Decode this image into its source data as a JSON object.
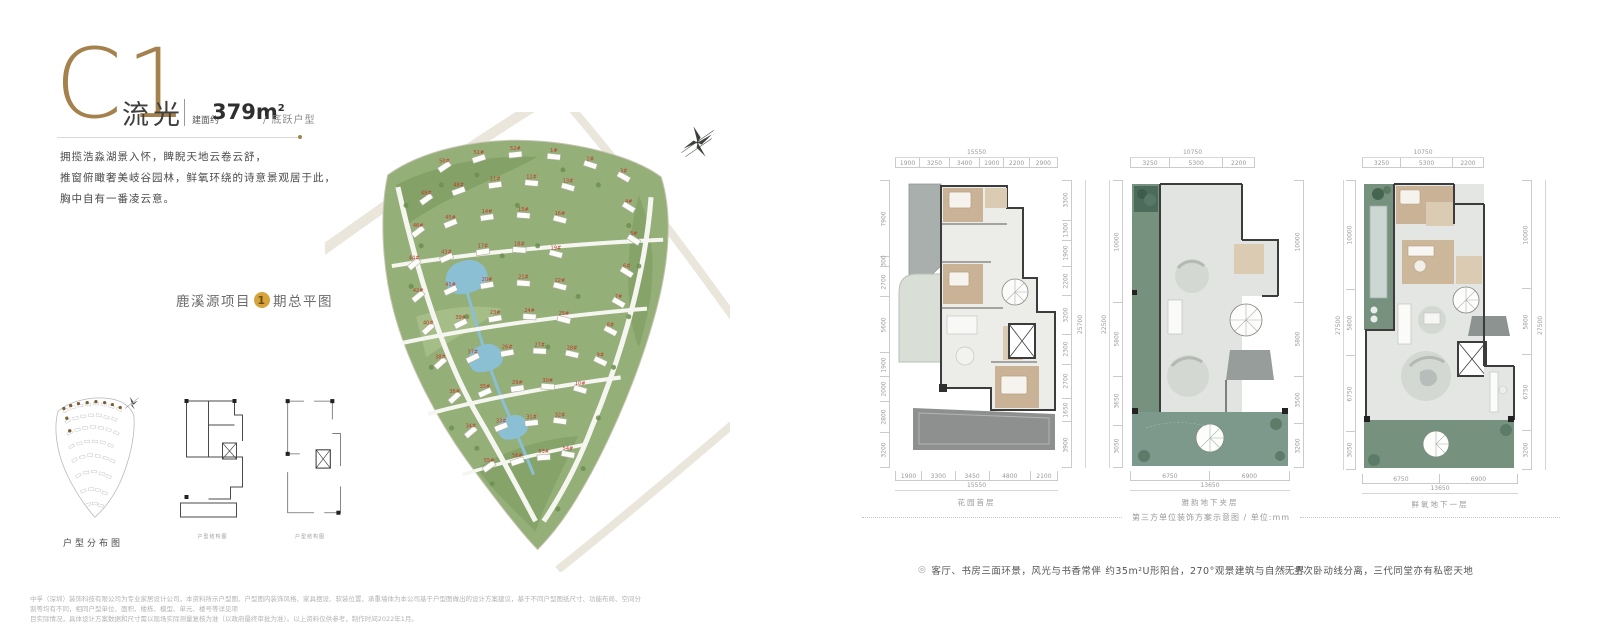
{
  "header": {
    "unit_code": "C1",
    "unit_name": "流光",
    "area_label": "建面约",
    "area_value": "379m",
    "area_sup": "2",
    "type_label": "/ 底跃户型"
  },
  "intro": {
    "line1": "拥揽浩淼湖景入怀，睥睨天地云卷云舒，",
    "line2": "推窗俯瞰奢美岐谷园林，鲜氧环绕的诗意景观居于此，",
    "line3": "胸中自有一番凌云意。"
  },
  "masterplan": {
    "label_prefix": "鹿溪源项目",
    "phase_number": "1",
    "label_suffix": "期总平图",
    "building_label_color": "#c23a2c",
    "buildings": [
      {
        "n": "50#",
        "x": 118,
        "y": 52,
        "r": -34
      },
      {
        "n": "51#",
        "x": 152,
        "y": 44,
        "r": -18
      },
      {
        "n": "52#",
        "x": 188,
        "y": 40,
        "r": -6
      },
      {
        "n": "1#",
        "x": 226,
        "y": 42,
        "r": 6
      },
      {
        "n": "2#",
        "x": 262,
        "y": 50,
        "r": 18
      },
      {
        "n": "3#",
        "x": 295,
        "y": 62,
        "r": 30
      },
      {
        "n": "49#",
        "x": 100,
        "y": 84,
        "r": -36
      },
      {
        "n": "48#",
        "x": 132,
        "y": 76,
        "r": -20
      },
      {
        "n": "11#",
        "x": 168,
        "y": 70,
        "r": -8
      },
      {
        "n": "12#",
        "x": 204,
        "y": 68,
        "r": 5
      },
      {
        "n": "13#",
        "x": 240,
        "y": 72,
        "r": 16
      },
      {
        "n": "4#",
        "x": 300,
        "y": 92,
        "r": 32
      },
      {
        "n": "46#",
        "x": 92,
        "y": 116,
        "r": -38
      },
      {
        "n": "45#",
        "x": 124,
        "y": 108,
        "r": -22
      },
      {
        "n": "14#",
        "x": 160,
        "y": 102,
        "r": -8
      },
      {
        "n": "15#",
        "x": 196,
        "y": 100,
        "r": 4
      },
      {
        "n": "16#",
        "x": 232,
        "y": 104,
        "r": 15
      },
      {
        "n": "5#",
        "x": 305,
        "y": 124,
        "r": 33
      },
      {
        "n": "44#",
        "x": 88,
        "y": 148,
        "r": -40
      },
      {
        "n": "43#",
        "x": 120,
        "y": 142,
        "r": -24
      },
      {
        "n": "17#",
        "x": 156,
        "y": 136,
        "r": -9
      },
      {
        "n": "18#",
        "x": 192,
        "y": 134,
        "r": 4
      },
      {
        "n": "19#",
        "x": 228,
        "y": 138,
        "r": 15
      },
      {
        "n": "6#",
        "x": 298,
        "y": 156,
        "r": 32
      },
      {
        "n": "42#",
        "x": 92,
        "y": 180,
        "r": -40
      },
      {
        "n": "41#",
        "x": 124,
        "y": 174,
        "r": -25
      },
      {
        "n": "20#",
        "x": 160,
        "y": 169,
        "r": -10
      },
      {
        "n": "21#",
        "x": 196,
        "y": 167,
        "r": 4
      },
      {
        "n": "22#",
        "x": 232,
        "y": 170,
        "r": 15
      },
      {
        "n": "7#",
        "x": 290,
        "y": 186,
        "r": 30
      },
      {
        "n": "40#",
        "x": 102,
        "y": 212,
        "r": -42
      },
      {
        "n": "39#",
        "x": 134,
        "y": 207,
        "r": -26
      },
      {
        "n": "23#",
        "x": 168,
        "y": 202,
        "r": -10
      },
      {
        "n": "24#",
        "x": 202,
        "y": 200,
        "r": 4
      },
      {
        "n": "25#",
        "x": 236,
        "y": 203,
        "r": 14
      },
      {
        "n": "8#",
        "x": 282,
        "y": 214,
        "r": 28
      },
      {
        "n": "38#",
        "x": 114,
        "y": 246,
        "r": -42
      },
      {
        "n": "37#",
        "x": 146,
        "y": 241,
        "r": -26
      },
      {
        "n": "26#",
        "x": 180,
        "y": 236,
        "r": -10
      },
      {
        "n": "27#",
        "x": 212,
        "y": 234,
        "r": 3
      },
      {
        "n": "28#",
        "x": 244,
        "y": 237,
        "r": 13
      },
      {
        "n": "9#",
        "x": 272,
        "y": 244,
        "r": 26
      },
      {
        "n": "36#",
        "x": 128,
        "y": 280,
        "r": -42
      },
      {
        "n": "35#",
        "x": 158,
        "y": 275,
        "r": -24
      },
      {
        "n": "29#",
        "x": 190,
        "y": 271,
        "r": -8
      },
      {
        "n": "30#",
        "x": 220,
        "y": 269,
        "r": 4
      },
      {
        "n": "10#",
        "x": 252,
        "y": 272,
        "r": 16
      },
      {
        "n": "34#",
        "x": 144,
        "y": 314,
        "r": -40
      },
      {
        "n": "33#",
        "x": 174,
        "y": 309,
        "r": -22
      },
      {
        "n": "31#",
        "x": 204,
        "y": 305,
        "r": -6
      },
      {
        "n": "32#",
        "x": 232,
        "y": 303,
        "r": 8
      },
      {
        "n": "55#",
        "x": 162,
        "y": 348,
        "r": -36
      },
      {
        "n": "56#",
        "x": 190,
        "y": 343,
        "r": -18
      },
      {
        "n": "53#",
        "x": 216,
        "y": 339,
        "r": -4
      },
      {
        "n": "54#",
        "x": 240,
        "y": 336,
        "r": 10
      }
    ]
  },
  "mini_diagrams": {
    "distribution_label": "户型分布图",
    "structure_label_1": "户型结构图",
    "structure_label_2": "户型结构图"
  },
  "floorplans": [
    {
      "caption": "花园首层",
      "top_total": "15550",
      "top": [
        "1900",
        "3250",
        "3400",
        "1900",
        "2200",
        "2900"
      ],
      "bottom": [
        "1900",
        "3300",
        "3450",
        "4800",
        "2100"
      ],
      "bottom_total": "15550",
      "left": [
        "7900",
        "300",
        "2700",
        "5600",
        "1900",
        "2000",
        "2800",
        "3200"
      ],
      "right": [
        "3300",
        "1300",
        "1900",
        "2200",
        "3200",
        "2300",
        "2700",
        "1650",
        "3900"
      ],
      "right_total": "25700"
    },
    {
      "caption": "雅韵地下夹层",
      "top_total": "10750",
      "top": [
        "3250",
        "5300",
        "2200"
      ],
      "bottom": [
        "6750",
        "6900"
      ],
      "bottom_total": "13650",
      "left": [
        "10000",
        "5800",
        "3650",
        "3050"
      ],
      "left_total": "22500",
      "right": [
        "10000",
        "5800",
        "3500",
        "3200"
      ]
    },
    {
      "caption": "鲜氧地下一层",
      "top_total": "10750",
      "top": [
        "3250",
        "5300",
        "2200"
      ],
      "bottom": [
        "6750",
        "6900"
      ],
      "bottom_total": "13650",
      "left": [
        "10000",
        "5800",
        "6750",
        "3050"
      ],
      "left_total": "27500",
      "right": [
        "10000",
        "5800",
        "6750",
        "3200"
      ],
      "right_total": "27500"
    }
  ],
  "plan_note": "第三方单位装饰方案示意图 / 单位:mm",
  "features": [
    {
      "text": "客厅、书房三面环景，风光与书香常伴"
    },
    {
      "text": "约35m²U形阳台，270°观景建筑与自然无界"
    },
    {
      "text": "主次卧动线分离，三代同堂亦有私密天地"
    }
  ],
  "disclaimer": {
    "line1": "中孚（深圳）装饰科技有限公司为专业家居设计公司，本资料所示户型图、户型图内装饰风格、家具摆设、软装位置、承重墙体为本公司基于户型图做出的设计方案建议，基于不同户型图纸尺寸、功能布局、空间分割等均有不同，相同户型单位、面积、楼栋、模型、单元、楼号等详见项",
    "line2": "目实际情况，具体设计方案数据和尺寸需以现场实际测量复核为准（以政府最终审批为准）。以上资料仅供参考，制作时间2022年1月。"
  }
}
